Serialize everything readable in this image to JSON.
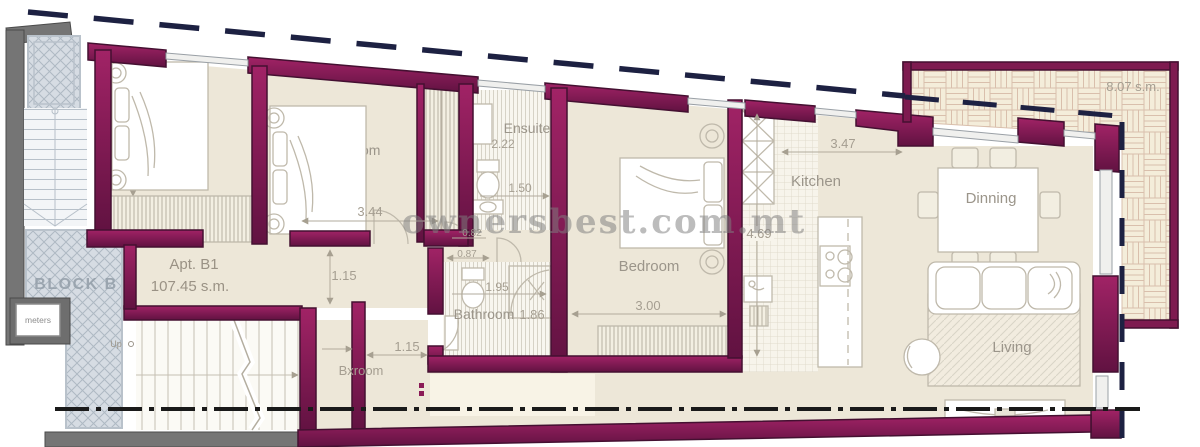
{
  "plan": {
    "watermark": "ownersbest.com.mt",
    "block": {
      "label": "BLOCK B"
    },
    "scale_box": {
      "label": "meters"
    },
    "apartment": {
      "name": "Apt. B1",
      "area": "107.45 s.m."
    },
    "terrace": {
      "area": "8.07 s.m."
    },
    "stairs": {
      "up": "Up"
    },
    "rooms": {
      "bedroom1": {
        "label": "Bedroom",
        "dim_width": "3.82"
      },
      "bedroom2": {
        "label": "Bedroom",
        "dim_width": "3.03",
        "dim_length": "3.44"
      },
      "corridor": {
        "dim_width": "1.15"
      },
      "lobby": {
        "dim_a": "0.82",
        "dim_b": "0.87"
      },
      "ensuite": {
        "label": "Ensuite",
        "dim_width": "2.22",
        "dim_length": "1.50"
      },
      "bathroom": {
        "label": "Bathroom",
        "dim_length": "1.95",
        "dim_width": "1.86"
      },
      "bxroom": {
        "label": "Bxroom",
        "dim_width": "1.15"
      },
      "bedroom3": {
        "label": "Bedroom",
        "dim_width": "3.00"
      },
      "kitchen": {
        "label": "Kitchen",
        "dim_width": "3.47",
        "dim_length": "4.69"
      },
      "dining": {
        "label": "Dinning"
      },
      "living": {
        "label": "Living"
      }
    },
    "colors": {
      "wall": "#8A1A56",
      "wall_dark": "#441031",
      "boundary": "#1D2142",
      "floor": "#EDE7D8",
      "common_wall": "#757575",
      "hatch_area": "#D6DCE3",
      "label_text": "#9B958A",
      "dim_text": "#A59E91",
      "watermark_text": "#7F7F7F",
      "block_text": "#96A1AB"
    }
  }
}
